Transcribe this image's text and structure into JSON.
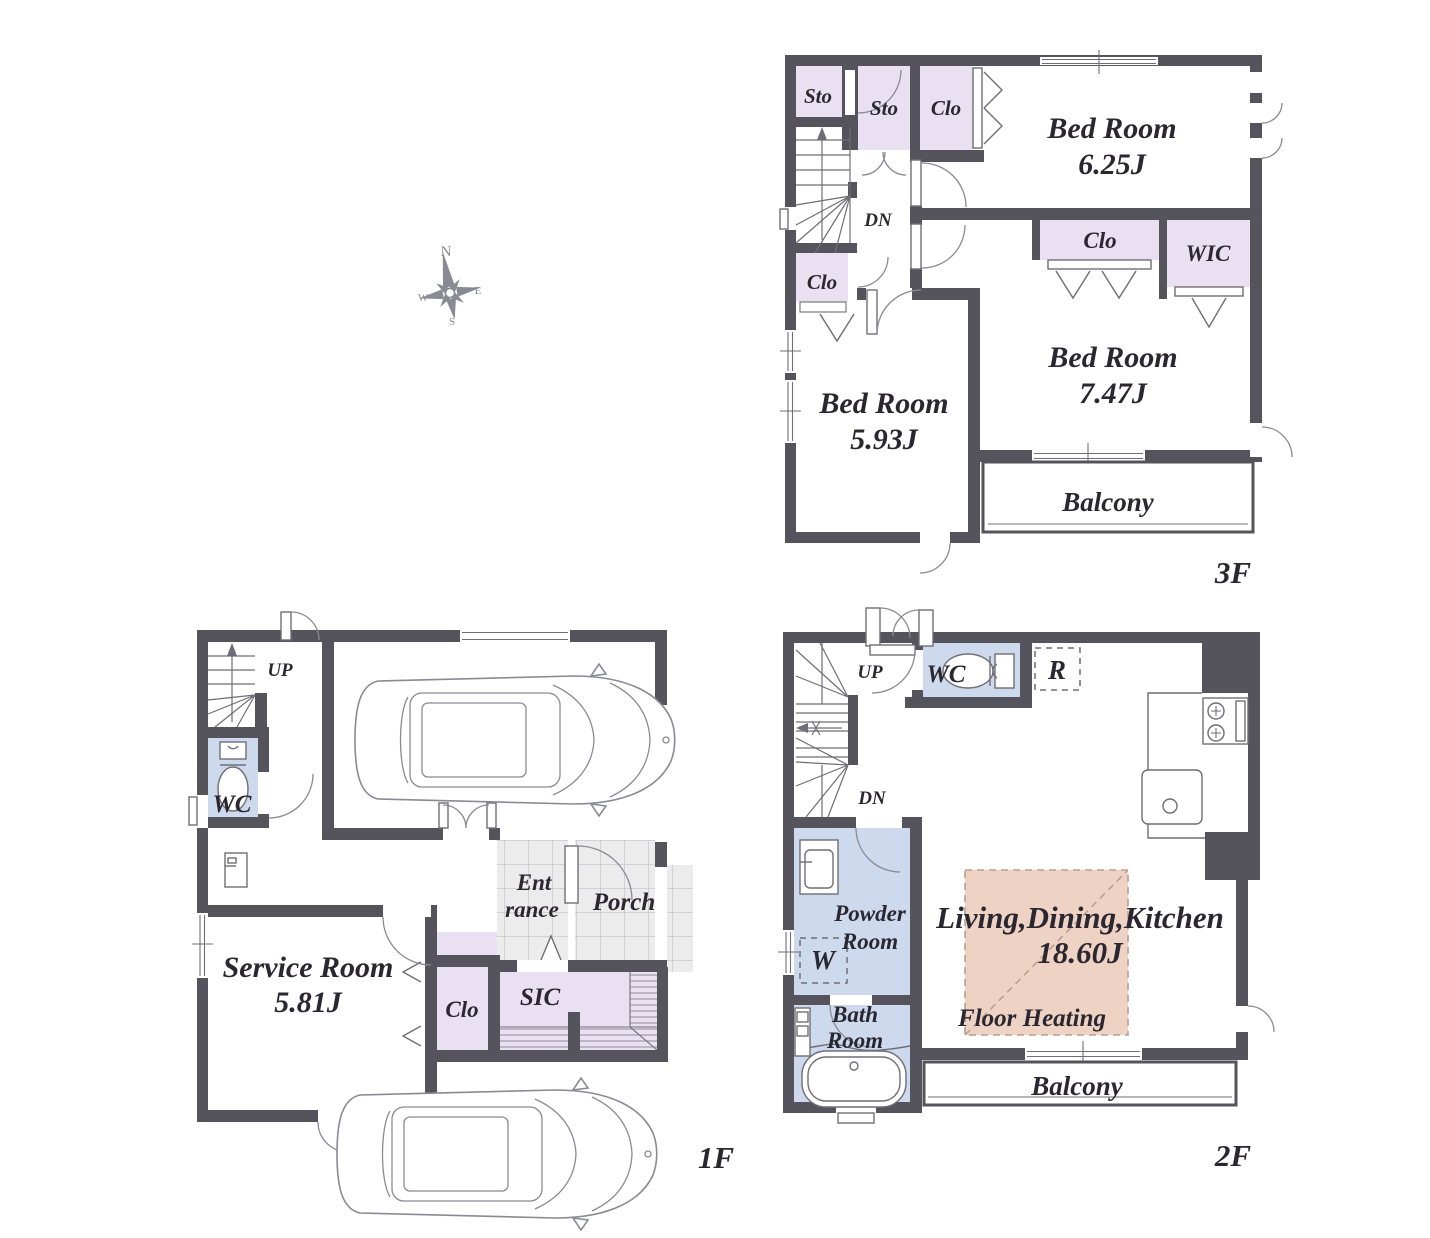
{
  "palette": {
    "wall": "#55545c",
    "ink": "#2b2731",
    "lavender": "#e9e1f1",
    "blue": "#cdd9ec",
    "salmon": "#eed2c4",
    "tile": "#ececec",
    "tile-line": "#b9b7bd",
    "fixture": "#6f6e76",
    "car": "#8a8a94",
    "heat-line": "#bb9f92"
  },
  "compass": {
    "n": "N",
    "e": "E",
    "s": "S",
    "w": "W"
  },
  "floors": {
    "f1": {
      "label": "1F",
      "rooms": {
        "up": "UP",
        "wc": "WC",
        "ent1": "Ent",
        "ent2": "rance",
        "porch": "Porch",
        "service": "Service Room",
        "service_area": "5.81J",
        "clo": "Clo",
        "sic": "SIC"
      }
    },
    "f2": {
      "label": "2F",
      "rooms": {
        "up": "UP",
        "dn": "DN",
        "wc": "WC",
        "fridge": "R",
        "powder1": "Powder",
        "powder2": "Room",
        "washer": "W",
        "bath1": "Bath",
        "bath2": "Room",
        "ldk": "Living,Dining,Kitchen",
        "ldk_area": "18.60J",
        "floor_heating": "Floor Heating",
        "balcony": "Balcony"
      }
    },
    "f3": {
      "label": "3F",
      "rooms": {
        "sto_a": "Sto",
        "sto_b": "Sto",
        "clo_a": "Clo",
        "bed_a": "Bed Room",
        "bed_a_area": "6.25J",
        "dn": "DN",
        "clo_b": "Clo",
        "wic": "WIC",
        "clo_c": "Clo",
        "bed_b": "Bed Room",
        "bed_b_area": "5.93J",
        "bed_c": "Bed Room",
        "bed_c_area": "7.47J",
        "balcony": "Balcony"
      }
    }
  }
}
